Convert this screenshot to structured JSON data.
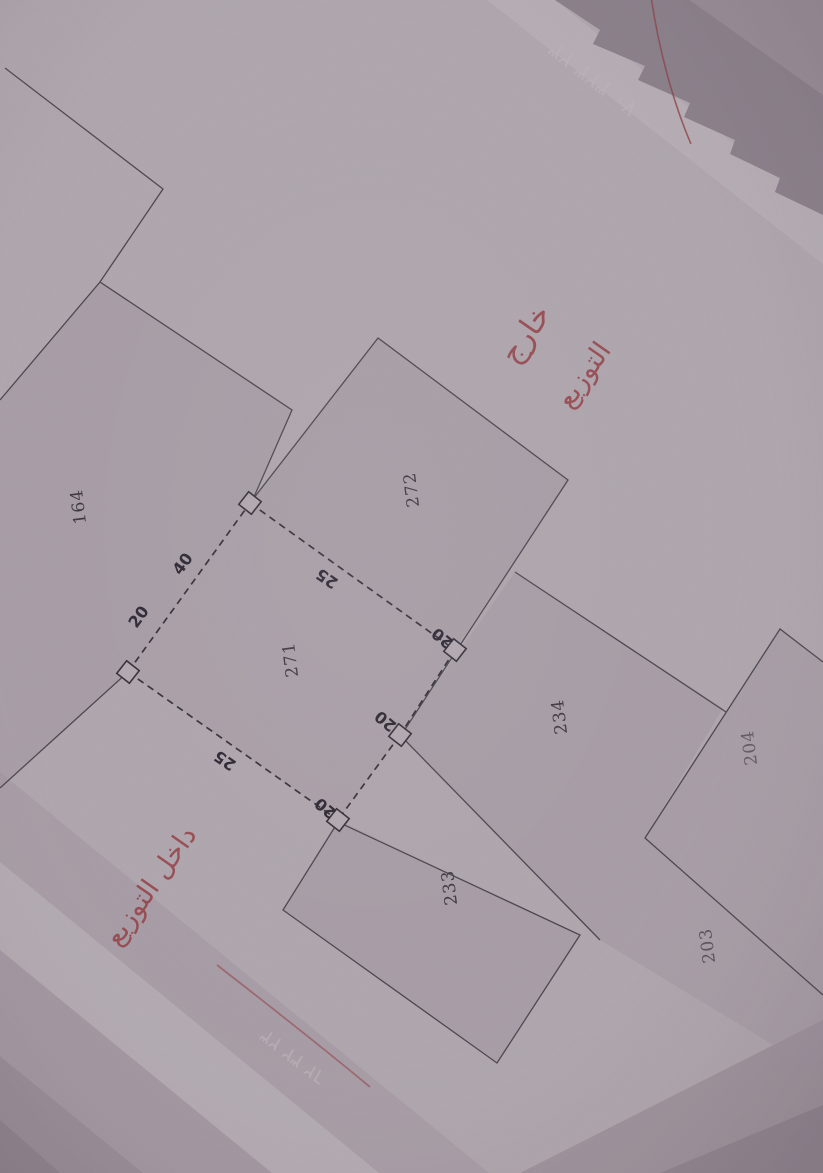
{
  "plan": {
    "plots": [
      {
        "number": "164"
      },
      {
        "number": "272"
      },
      {
        "number": "271"
      },
      {
        "number": "234"
      },
      {
        "number": "233"
      },
      {
        "number": "204"
      },
      {
        "number": "203"
      }
    ],
    "dimensions": [
      {
        "value": "20"
      },
      {
        "value": "40"
      },
      {
        "value": "25"
      },
      {
        "value": "20"
      },
      {
        "value": "20"
      },
      {
        "value": "20"
      },
      {
        "value": "25"
      }
    ]
  },
  "annotations_red": {
    "outside_word1": "خارج",
    "outside_word2": "التوزيع",
    "inside_phrase": "داخل التوزيع"
  },
  "ghost_text": {
    "top_right": "٢٣ ٣٢٣ ٧٠",
    "bottom_left": "٢٣ ٣٢ ٦٢"
  },
  "colors": {
    "paper": "#e3dbe1",
    "plot_shade": "#cfc3cd",
    "solid_ink": "#56505a",
    "dashed_ink": "#46404c",
    "red_ink": "#bd4a50",
    "band_dark": "#b2a8b2"
  }
}
